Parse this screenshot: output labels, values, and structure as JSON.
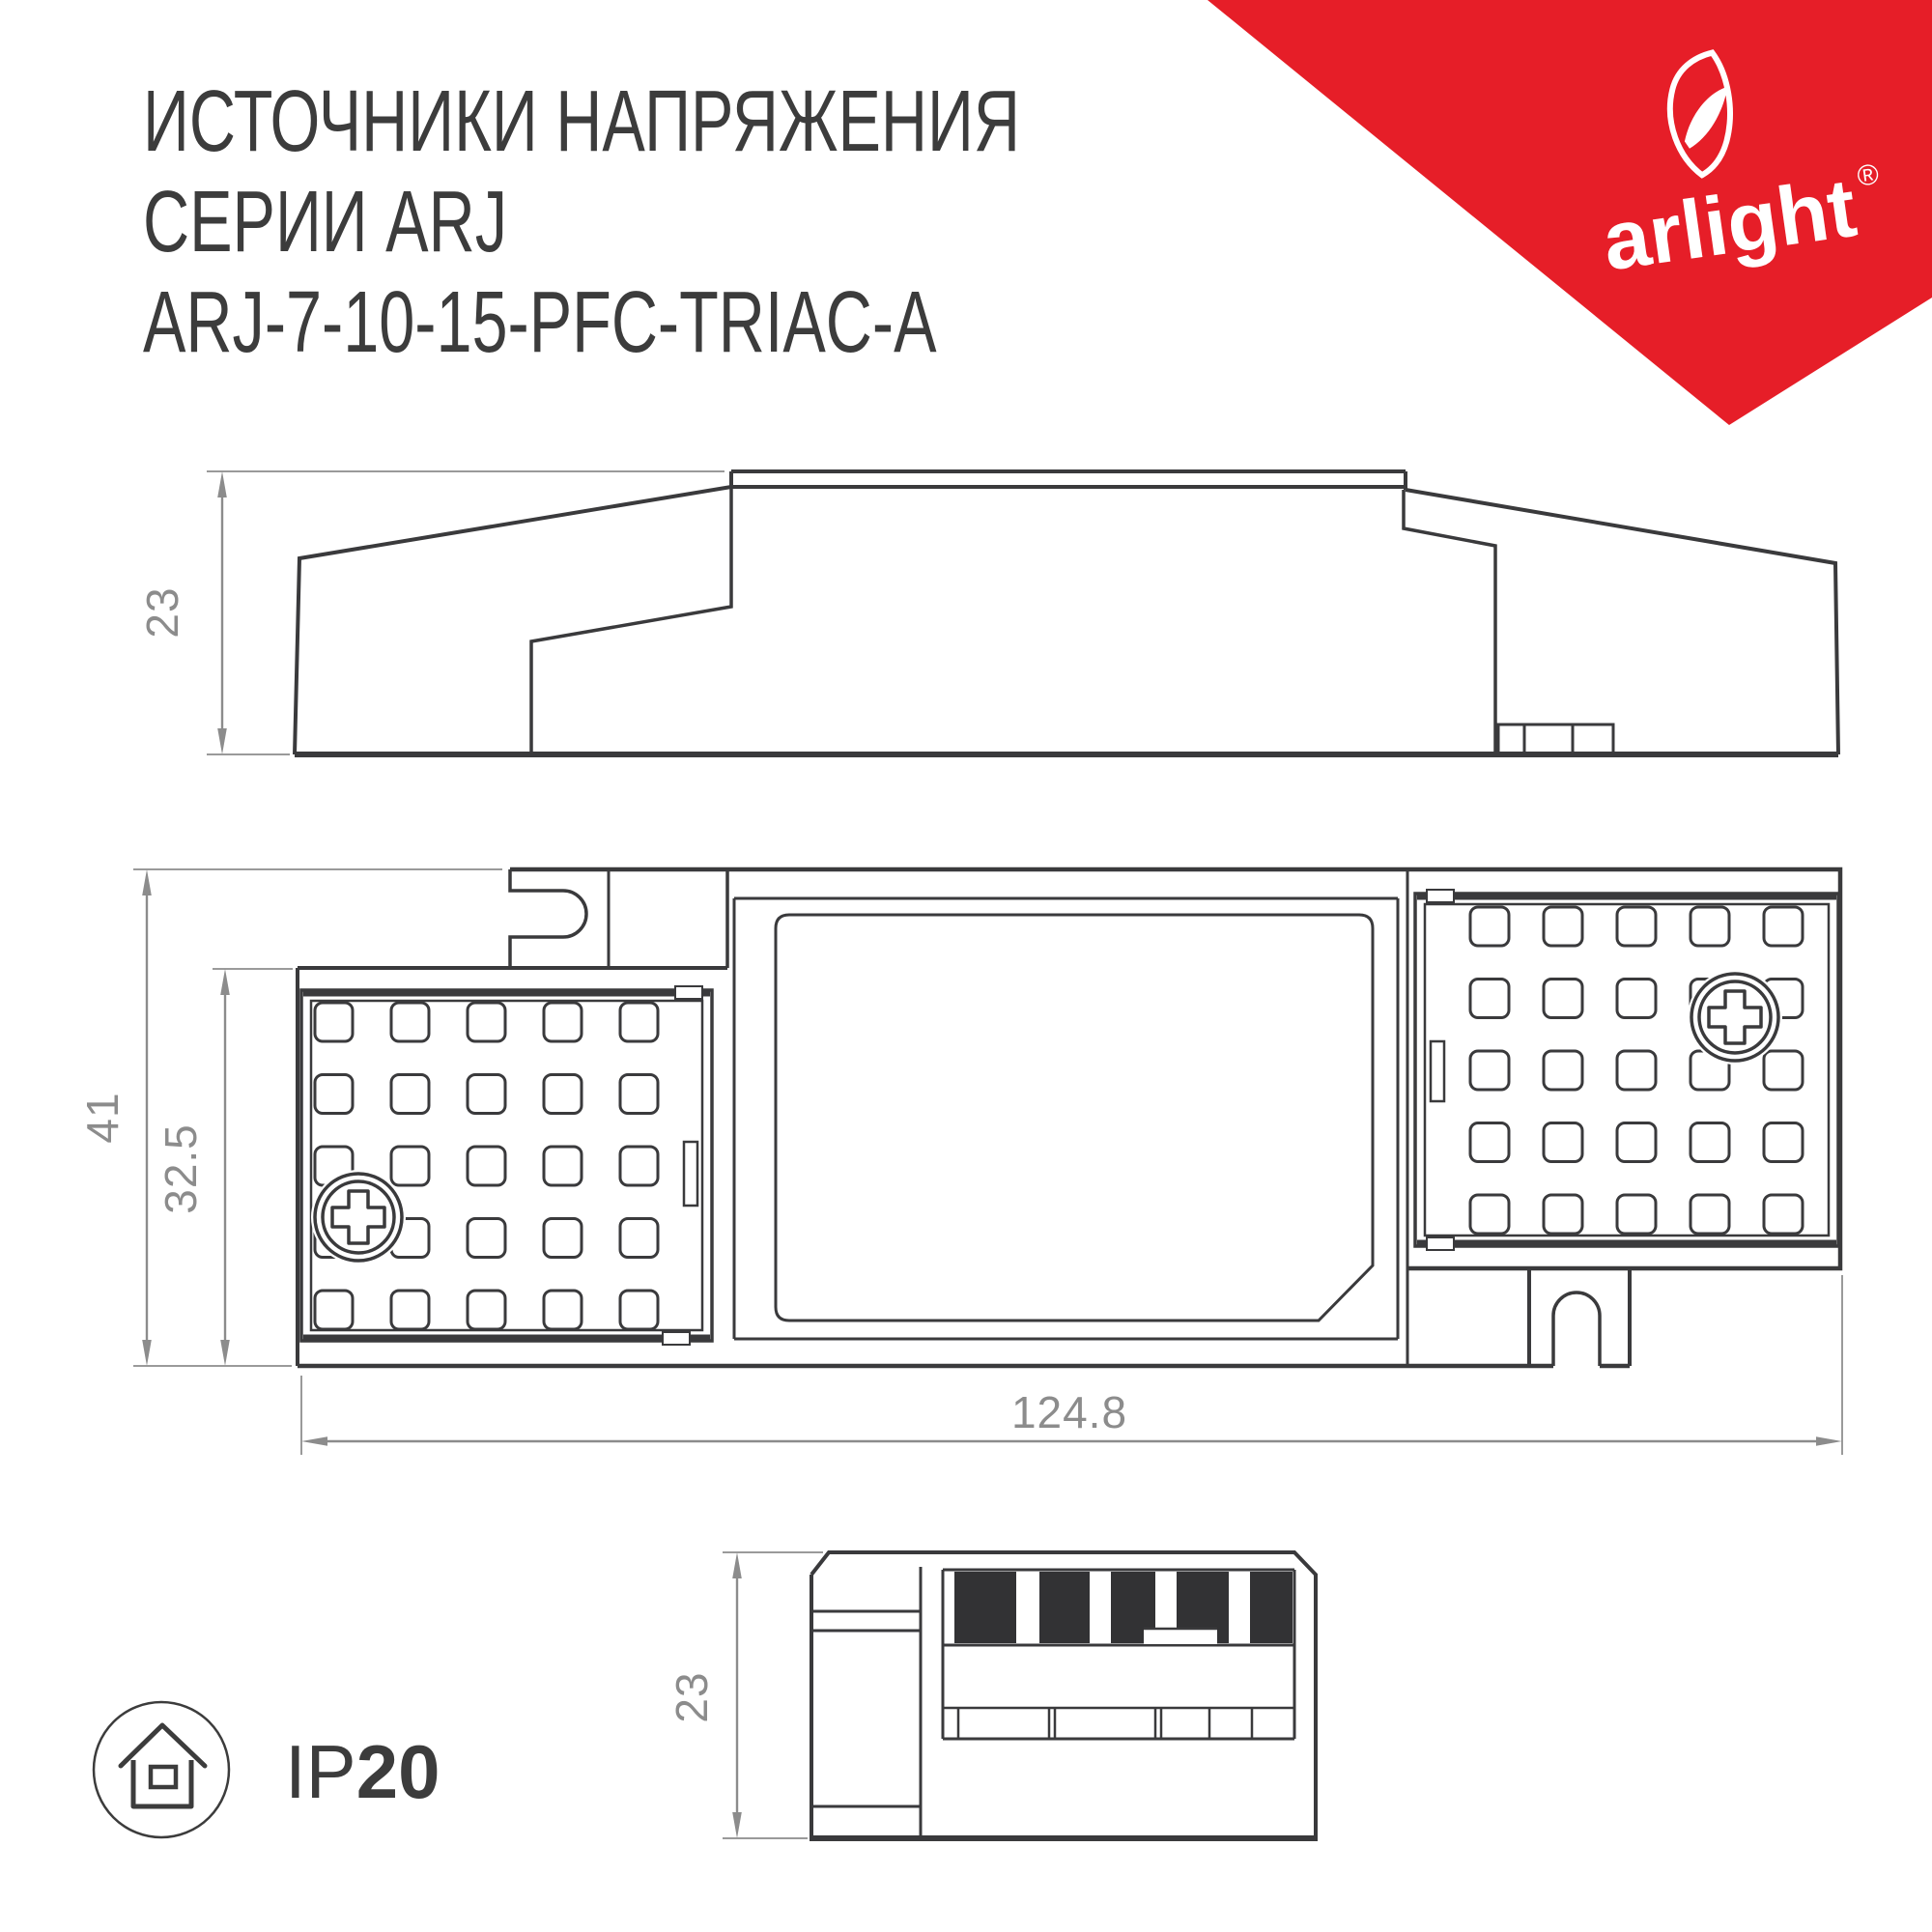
{
  "title": {
    "line1": "ИСТОЧНИКИ НАПРЯЖЕНИЯ",
    "line2": "СЕРИИ ARJ",
    "line3": "ARJ-7-10-15-PFC-TRIAC-A"
  },
  "logo": {
    "brand": "arlight",
    "registered": "®",
    "triangle_color": "#E61E28",
    "text_color": "#ffffff"
  },
  "dimensions": {
    "side_height": "23",
    "plan_height": "41",
    "plan_inner_height": "32.5",
    "total_length": "124.8",
    "end_height": "23"
  },
  "ip_rating": {
    "prefix": "IP",
    "value": "20"
  },
  "colors": {
    "line": "#3a3a3c",
    "dimension": "#8c8c8c",
    "accent_red": "#E61E28",
    "stripe_black": "#323234",
    "background": "#ffffff"
  },
  "icons": {
    "logo_icon": "arlight-leaf-icon",
    "protection_icon": "ip20-house-icon",
    "screw_icon": "phillips-screw-icon"
  }
}
